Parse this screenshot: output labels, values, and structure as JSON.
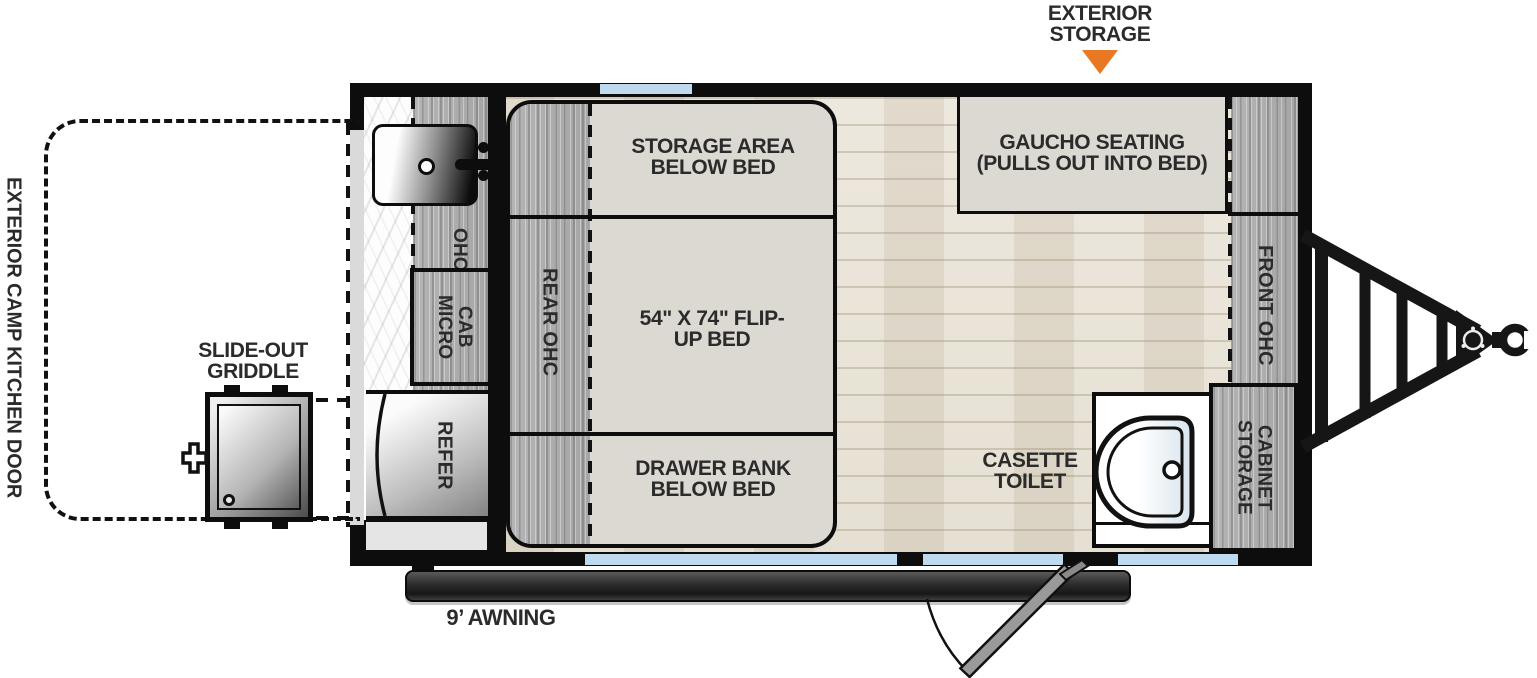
{
  "plan": {
    "callouts": {
      "exterior_storage": "EXTERIOR STORAGE",
      "exterior_camp_kitchen_door": "EXTERIOR CAMP KITCHEN DOOR",
      "slide_out_griddle": "SLIDE-OUT GRIDDLE",
      "awning": "9’ AWNING"
    },
    "areas": {
      "storage_area_below_bed": "STORAGE AREA BELOW BED",
      "flip_up_bed": "54\" X 74\" FLIP-UP BED",
      "drawer_bank_below_bed": "DRAWER BANK BELOW BED",
      "gaucho_seating": "GAUCHO SEATING (PULLS OUT INTO BED)",
      "rear_ohc": "REAR OHC",
      "front_ohc": "FRONT OHC",
      "ohc": "OHC",
      "micro_cab": "MICRO CAB",
      "refer": "REFER",
      "casette_toilet": "CASETTE TOILET",
      "storage_cabinet": "STORAGE CABINET"
    },
    "colors": {
      "accent": "#E87824",
      "windowblue": "#BFD9EE"
    }
  }
}
